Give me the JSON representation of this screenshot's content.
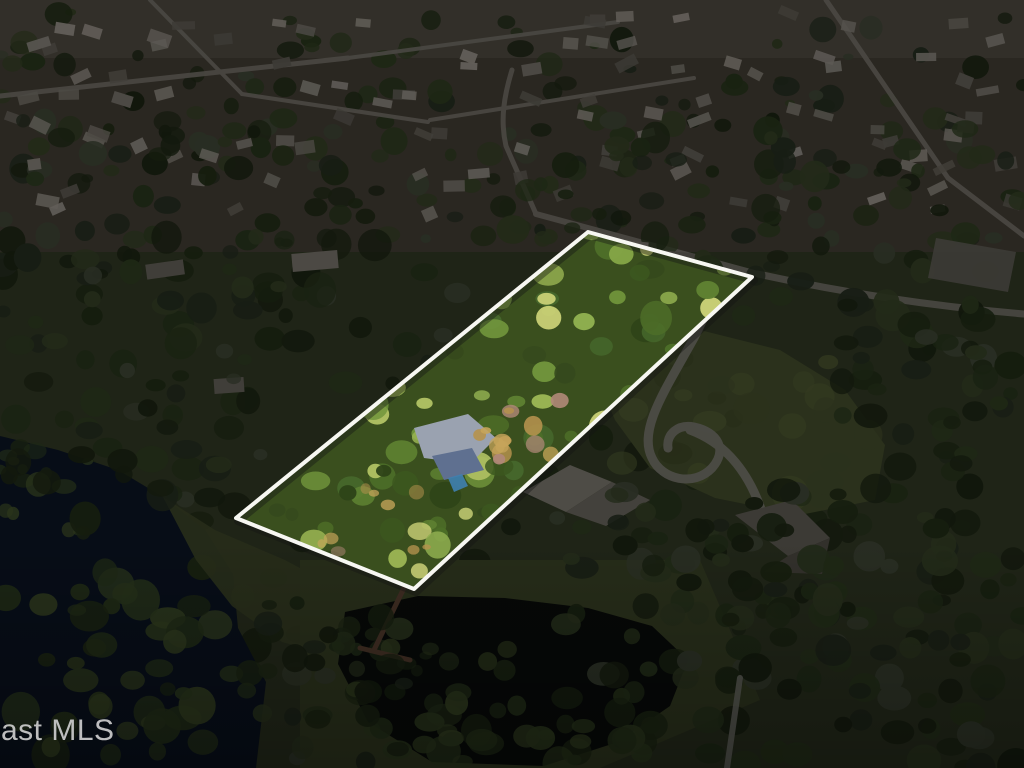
{
  "image_type": "aerial-real-estate-photo",
  "watermark": {
    "text": "ast MLS",
    "color": "#cdcdcd"
  },
  "property_outline": {
    "points": "588,232 752,277 414,589 236,518",
    "stroke_color": "#f7f7f2",
    "shadow_color": "#141414",
    "stroke_width": 4
  },
  "overlay": {
    "color": "#000000",
    "opacity": 0.45
  },
  "palette": {
    "base_ground": "#39422a",
    "neighborhood_ground": "#4d473c",
    "distant_haze": "#6a6458",
    "road": "#87837a",
    "roof_colors": [
      "#9d988e",
      "#8b867c",
      "#a8a29a",
      "#767168",
      "#b1aaa0",
      "#6f6b62"
    ],
    "tree_dark": [
      "#1f2a16",
      "#27351b",
      "#2f3f21",
      "#374827",
      "#3f4d2d",
      "#4a5340",
      "#232e19",
      "#2b3626"
    ],
    "lake_water": "#0e192a",
    "pond_water": "#0b100d",
    "marsh_green": [
      "#2b3a1d",
      "#364826",
      "#41542c",
      "#4c5e31"
    ],
    "shore_grass": "#46502e",
    "lawn": "#4f5a33",
    "lawn_light": "#5d6a3b",
    "driveway": "#8b8a80",
    "dock_wood": "#6d4f3c",
    "boardwalk": "#8f9086",
    "house_roof_main": "#8f8b80",
    "house_roof_facet": "#7b776d",
    "house_roof_right": "#6e6a62",
    "house_roof_right_facet": "#5c584f",
    "parking_lot": "#6f6c64",
    "property_base": "#3a4f1e",
    "property_trees": [
      "#2e4418",
      "#3c571f",
      "#4d6e28",
      "#5f8232",
      "#71953c",
      "#85a747",
      "#9ab453",
      "#b0c163",
      "#c6cd74",
      "#46682c",
      "#8fae4f",
      "#35491d"
    ],
    "property_accents": [
      "#b5924e",
      "#c7a55a",
      "#b08878"
    ],
    "tarp_light": "#9aa2b0",
    "tarp_dark": "#5f7090",
    "pool_blue": "#3f7fb0"
  }
}
